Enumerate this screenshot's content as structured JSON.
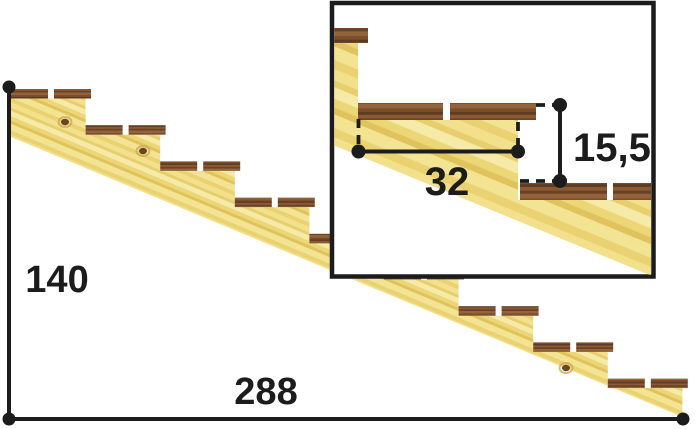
{
  "diagram": {
    "name": "stair-stringer-dimension-drawing",
    "background": "#ffffff",
    "dimensions": {
      "total_rise": "140",
      "total_run": "288",
      "step_run": "32",
      "step_rise": "15,5"
    },
    "main_stairs": {
      "step_count": 9,
      "planks_per_tread": 2
    },
    "inset": {
      "visible_treads": 3
    },
    "colors": {
      "line": "#1c1c1c",
      "text": "#1c1c1c",
      "inset_border": "#1c1c1c",
      "inset_background": "#ffffff",
      "stringer_grain": [
        "#f2e08c",
        "#e7cf6d",
        "#f6eaa8",
        "#ecd676",
        "#e0c35c",
        "#f3e494",
        "#ead272"
      ],
      "tread_grain": [
        "#7b4d2c",
        "#5d3a22",
        "#8a5a34",
        "#6b4226",
        "#936339"
      ],
      "knot": "#6d4524",
      "knot_ring": "#caa854"
    }
  }
}
